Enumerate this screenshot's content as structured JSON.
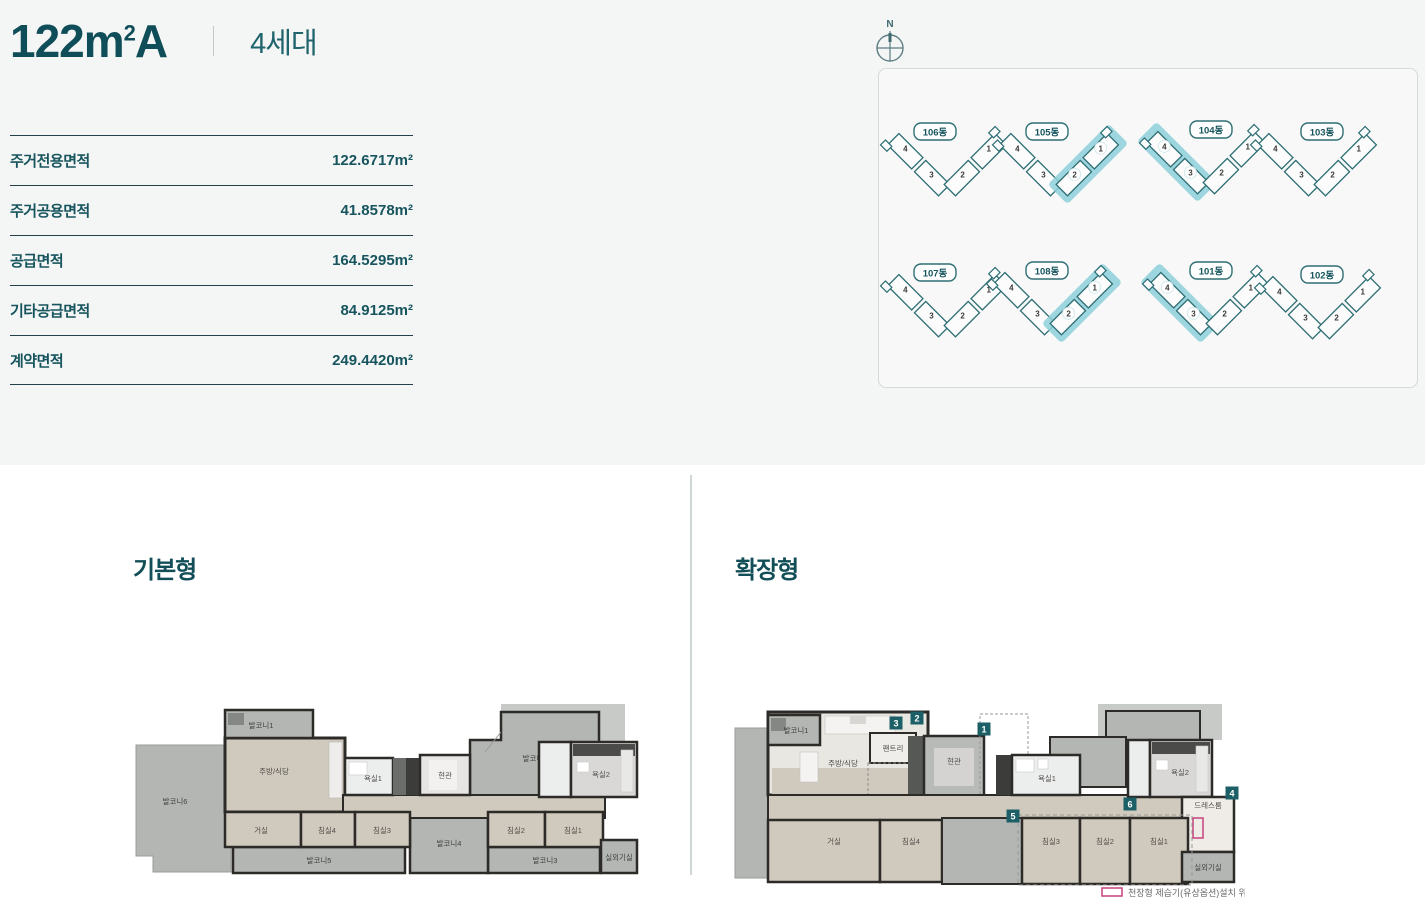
{
  "header": {
    "title_main": "122m",
    "title_sup": "2",
    "title_suffix": "A",
    "subtitle": "4세대"
  },
  "spec_table": {
    "rows": [
      {
        "label": "주거전용면적",
        "value": "122.6717m²"
      },
      {
        "label": "주거공용면적",
        "value": "41.8578m²"
      },
      {
        "label": "공급면적",
        "value": "164.5295m²"
      },
      {
        "label": "기타공급면적",
        "value": "84.9125m²"
      },
      {
        "label": "계약면적",
        "value": "249.4420m²"
      }
    ]
  },
  "site_plan": {
    "compass_label": "N",
    "unit_numbers": [
      "1",
      "2",
      "3",
      "4"
    ],
    "outline_color": "#2e6e74",
    "highlight_color": "#8ed0da",
    "buildings": [
      {
        "name": "106동",
        "highlighted_units": []
      },
      {
        "name": "105동",
        "highlighted_units": [
          "1",
          "2"
        ]
      },
      {
        "name": "104동",
        "highlighted_units": [
          "3",
          "4"
        ]
      },
      {
        "name": "103동",
        "highlighted_units": []
      },
      {
        "name": "107동",
        "highlighted_units": []
      },
      {
        "name": "108동",
        "highlighted_units": [
          "1",
          "2"
        ]
      },
      {
        "name": "101동",
        "highlighted_units": [
          "3",
          "4"
        ]
      },
      {
        "name": "102동",
        "highlighted_units": []
      }
    ]
  },
  "floor_plans": {
    "basic": {
      "title": "기본형",
      "rooms": {
        "balcony1": "발코니1",
        "balcony2": "발코니2",
        "balcony3": "발코니3",
        "balcony4": "발코니4",
        "balcony5": "발코니5",
        "balcony6": "발코니6",
        "kitchen": "주방/식당",
        "living": "거실",
        "bed1": "침실1",
        "bed2": "침실2",
        "bed3": "침실3",
        "bed4": "침실4",
        "bath1": "욕실1",
        "bath2": "욕실2",
        "entrance": "현관",
        "outdoor_unit": "실외기실"
      }
    },
    "extended": {
      "title": "확장형",
      "rooms": {
        "balcony1": "발코니1",
        "kitchen": "주방/식당",
        "pantry": "팬트리",
        "entrance": "현관",
        "bath1": "욕실1",
        "bath2": "욕실2",
        "dress": "드레스룸",
        "living": "거실",
        "bed1": "침실1",
        "bed2": "침실2",
        "bed3": "침실3",
        "bed4": "침실4",
        "outdoor_unit": "실외기실"
      },
      "badges": [
        "1",
        "2",
        "3",
        "4",
        "5",
        "6"
      ],
      "legend": {
        "label": "천장형 제습기(유상옵션)설치 위치",
        "swatch_color": "#c8417f"
      }
    }
  }
}
